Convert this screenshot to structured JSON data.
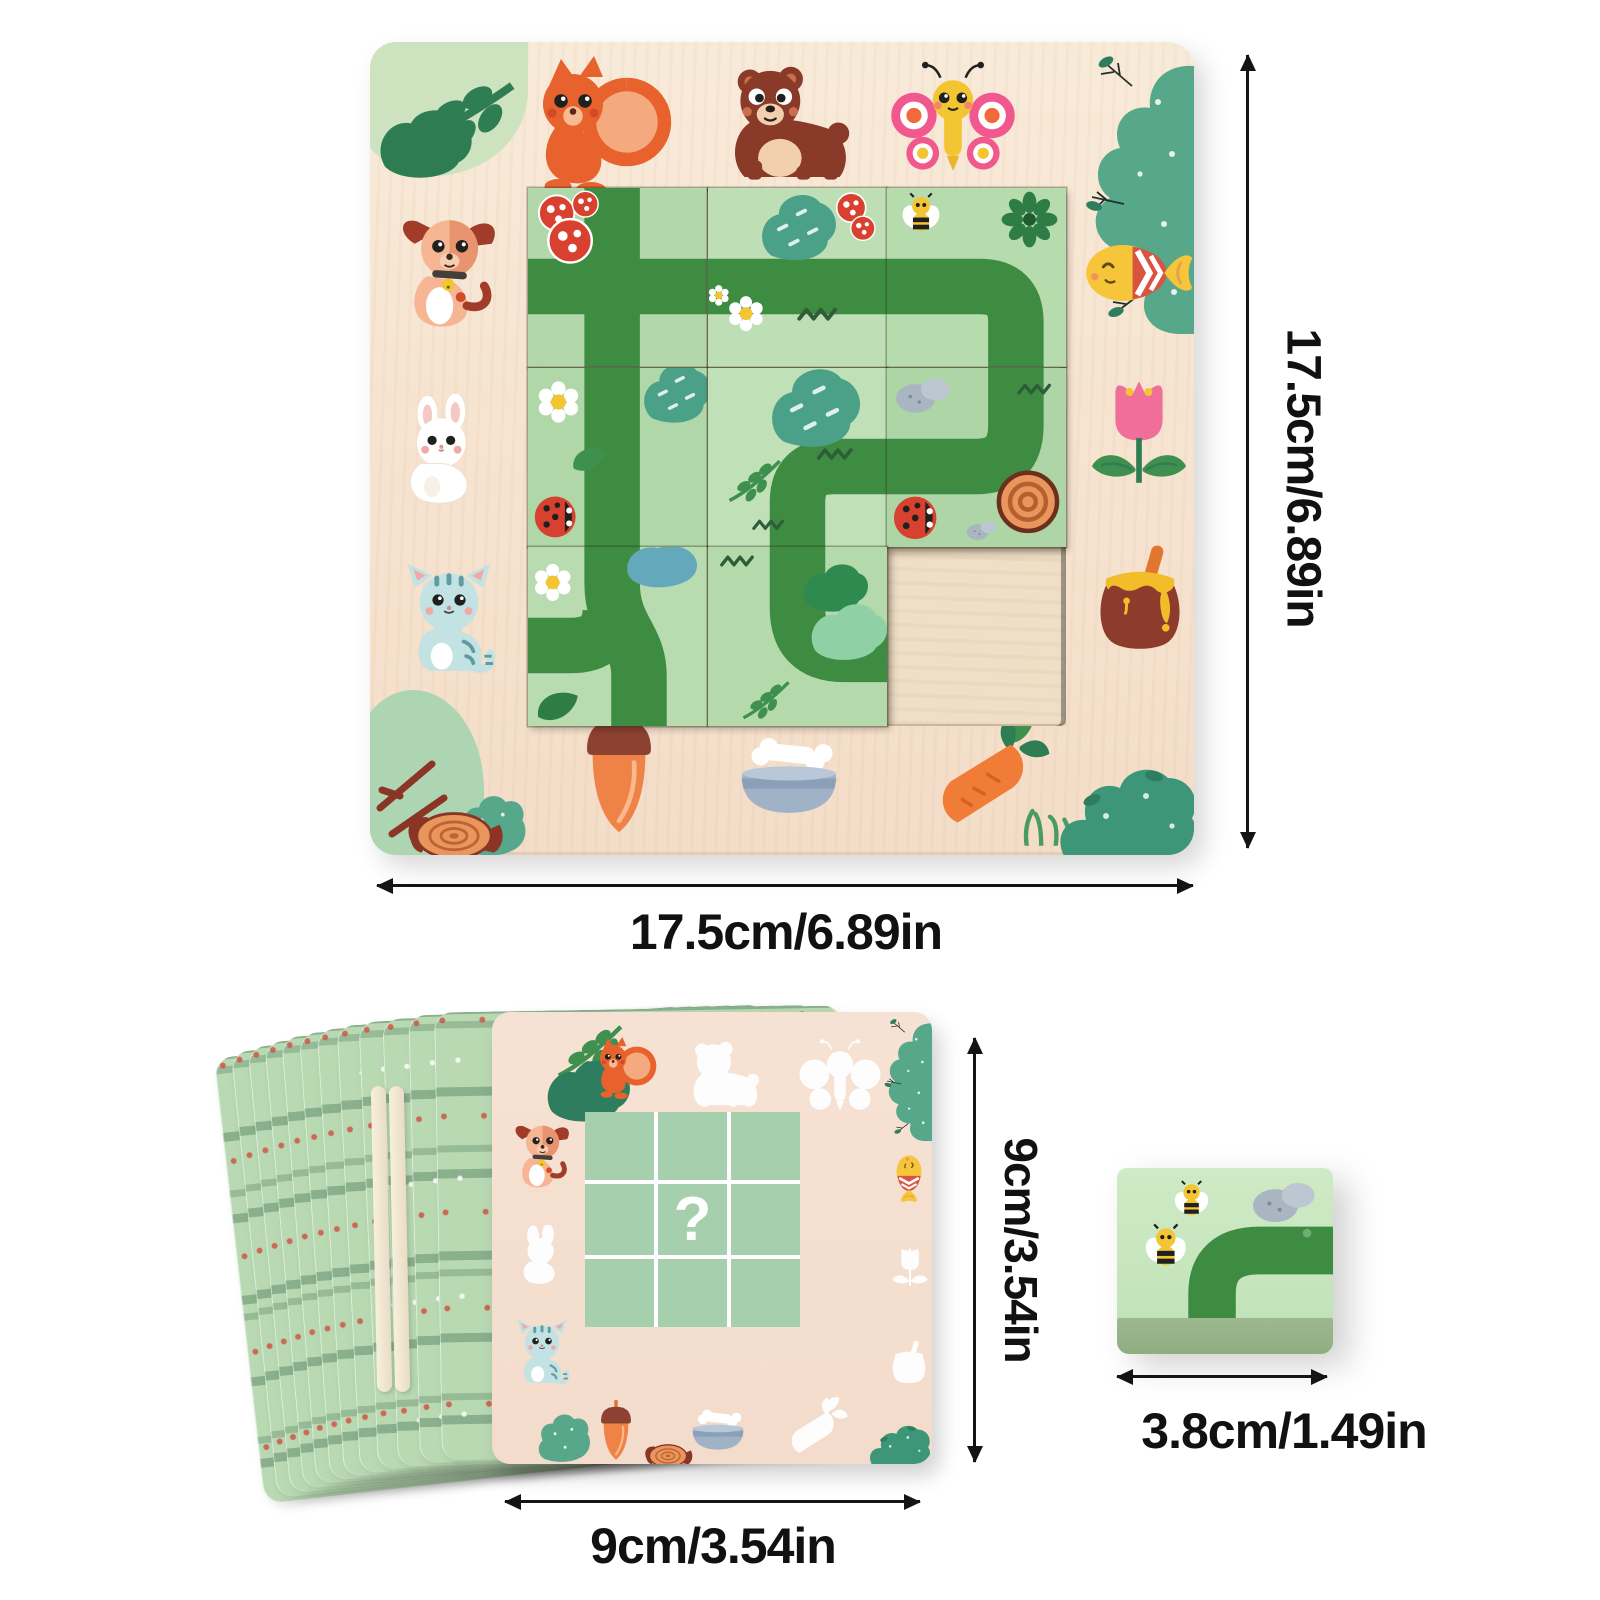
{
  "scene": {
    "description": "wooden forest maze puzzle toy - product dimension image",
    "background": "#ffffff"
  },
  "labels": {
    "board_height": "17.5cm/6.89in",
    "board_width": "17.5cm/6.89in",
    "cards_height": "9cm/3.54in",
    "cards_width": "9cm/3.54in",
    "tile_width": "3.8cm/1.49in",
    "front_card_question_mark": "?"
  },
  "board": {
    "grid_rows": 3,
    "grid_cols": 3,
    "empty_cell": "bottom-right",
    "border_icons_top": [
      "foliage-sprig",
      "squirrel",
      "bear",
      "butterfly",
      "berry-bush"
    ],
    "border_icons_left": [
      "dog",
      "rabbit",
      "cat"
    ],
    "border_icons_right": [
      "fish",
      "tulip",
      "honey-pot"
    ],
    "border_icons_bottom": [
      "tree-stump",
      "acorn",
      "dog-bowl-with-bone",
      "carrot",
      "corner-bush"
    ],
    "tile_motifs": [
      "mushrooms + cross road",
      "bush + mushrooms + straight road",
      "bee + dark flower + corner road",
      "daisy + tree + ladybug + straight road",
      "trees + curve road",
      "stones + ladybug + log + corner road",
      "daisy + pond + junction road",
      "bushes + curve road",
      "empty wood recess"
    ]
  },
  "cards": {
    "back_cards_visible": 12,
    "back_pattern": "green leafy rows with tiny red flowers",
    "front_card": {
      "colored_icons": [
        "squirrel",
        "dog",
        "cat",
        "fish",
        "acorn",
        "dog-bowl-with-bone"
      ],
      "white_silhouette_icons": [
        "bear",
        "butterfly",
        "rabbit",
        "tulip",
        "honey-pot",
        "carrot"
      ],
      "center": "3x3 green grid with question mark in middle cell"
    }
  },
  "single_tile": {
    "motifs": [
      "bee",
      "bee",
      "pebbles",
      "curved path"
    ],
    "face_color": "#c9e7c0",
    "side_color": "#9db88e"
  },
  "colors": {
    "board_wood": "#f6e4d0",
    "recess_wood": "#eedfc6",
    "tile_green": "#b7dcb2",
    "path_green": "#3e8c42",
    "card_back_green": "#b9d9b3",
    "card_front_pink": "#f5e0d2",
    "mini_grid_green": "#a6cfad",
    "dimension_text": "#111111"
  }
}
